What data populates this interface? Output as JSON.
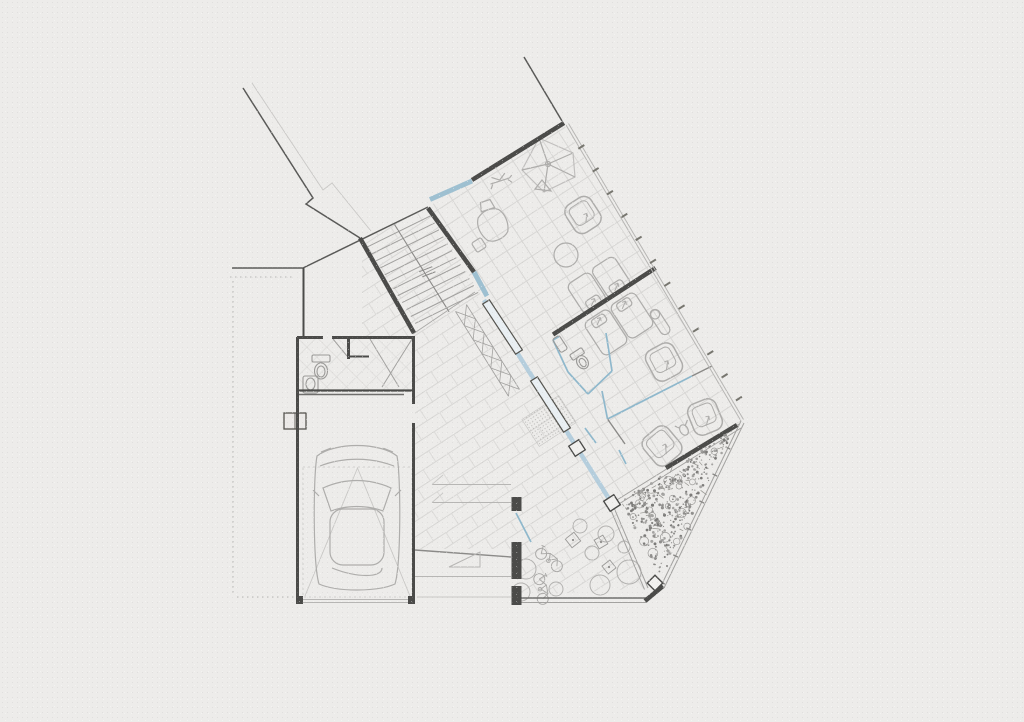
{
  "document": {
    "type": "architectural-drawing",
    "view": "ground-floor-plan",
    "contains_text": false
  },
  "palette": {
    "paper": "#edecea",
    "wall_dark": "#4b4b49",
    "wall_mid": "#6f6e6c",
    "line_mid": "#8b8a88",
    "line_light": "#b7b6b4",
    "tile": "#d8d7d5",
    "glass_blue": "#8fb8cc",
    "glass_blue_light": "#b5cedd",
    "furniture": "#aeadab",
    "vegetation": "#8f8e8c"
  },
  "plan": {
    "rooms": [
      "hall",
      "staircase",
      "bathroom",
      "garage",
      "bedroom-1",
      "bedroom-2",
      "ensuite-wc",
      "bedroom-3",
      "terrace",
      "garden"
    ],
    "objects": [
      "car",
      "toilet",
      "sink",
      "beds",
      "armchairs",
      "floor-lamp",
      "round-table",
      "ceiling-fan",
      "toy-plane",
      "mannequin",
      "bicycles",
      "planters",
      "vegetation"
    ]
  },
  "render": {
    "floors": {
      "hall": "362,240 428,207 483,299 612,503 648,588 517,596 517,549 415,549 415,337 362,337",
      "wing": "428,207 563,123 741,421 612,503 483,299"
    },
    "stairs": {
      "a": [
        363,
        240
      ],
      "b": [
        426,
        209
      ],
      "dir": [
        0.53,
        0.848
      ],
      "count": 12,
      "step": 8.2
    },
    "xband": {
      "start": [
        461,
        308
      ],
      "dir": [
        0.53,
        0.848
      ],
      "len": 100,
      "halfw": 6.5,
      "cells": 6
    },
    "mullions": {
      "p": [
        567,
        124
      ],
      "dir": [
        0.5306,
        0.8476
      ],
      "len": 345,
      "step": 27,
      "half": 3.5
    },
    "fence": {
      "p": [
        741,
        421
      ],
      "dir": [
        -0.436,
        0.9
      ],
      "len": 183,
      "step": 30,
      "half": 2.6
    },
    "glass_panels": [
      [
        [
          486,
          302
        ],
        [
          519,
          352
        ]
      ],
      [
        [
          534,
          379
        ],
        [
          567,
          430
        ]
      ]
    ],
    "piers": [
      [
        577,
        448,
        12,
        57
      ]
    ],
    "beds": [
      {
        "cx": 599,
        "cy": 285,
        "angle": -33,
        "len": 56,
        "wid": 35,
        "pillow": 1
      },
      {
        "cx": 619,
        "cy": 324,
        "angle": -33,
        "len": 60,
        "wid": 40,
        "pillow": -1
      }
    ],
    "chairs": [
      {
        "cx": 583,
        "cy": 215,
        "angle": -33,
        "s": 30
      },
      {
        "cx": 664,
        "cy": 362,
        "angle": -28,
        "s": 31
      },
      {
        "cx": 705,
        "cy": 417,
        "angle": -22,
        "s": 30
      },
      {
        "cx": 662,
        "cy": 446,
        "angle": -40,
        "s": 32
      }
    ],
    "squares": [
      [
        573,
        540,
        11,
        -38
      ],
      [
        601,
        542,
        10,
        -30
      ],
      [
        609,
        567,
        10,
        -38
      ]
    ],
    "circles": [
      [
        580,
        526,
        7
      ],
      [
        606,
        534,
        8
      ],
      [
        592,
        553,
        7
      ],
      [
        629,
        572,
        12
      ],
      [
        600,
        585,
        10
      ],
      [
        526,
        569,
        10
      ],
      [
        521,
        592,
        9
      ],
      [
        556,
        589,
        7
      ],
      [
        624,
        547,
        6
      ]
    ],
    "bikes": [
      [
        549,
        560,
        38
      ],
      [
        541,
        589,
        80
      ]
    ],
    "garden": {
      "tri": [
        [
          612,
          503
        ],
        [
          741,
          421
        ],
        [
          661,
          586
        ]
      ],
      "dots": 340,
      "circles": 22,
      "twigs": 36,
      "seed": 12
    }
  }
}
